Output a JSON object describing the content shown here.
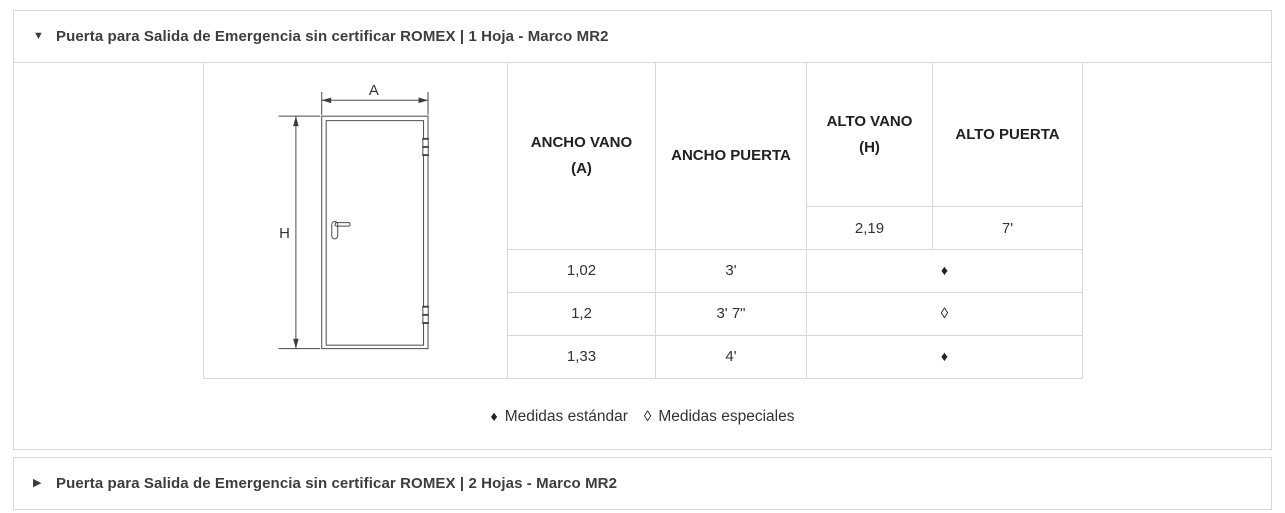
{
  "icons": {
    "expanded_glyph": "▼",
    "collapsed_glyph": "▶"
  },
  "sections": {
    "expanded": {
      "title": "Puerta para Salida de Emergencia sin certificar ROMEX | 1 Hoja - Marco MR2"
    },
    "collapsed": {
      "title": "Puerta para Salida de Emergencia sin certificar ROMEX | 2 Hojas - Marco MR2"
    }
  },
  "diagram": {
    "width_label": "A",
    "height_label": "H"
  },
  "spec_table": {
    "headers": {
      "ancho_vano_line1": "ANCHO VANO",
      "ancho_vano_line2": "(A)",
      "ancho_puerta": "ANCHO PUERTA",
      "alto_vano_line1": "ALTO VANO",
      "alto_vano_line2": "(H)",
      "alto_puerta": "ALTO PUERTA"
    },
    "alto_values": {
      "alto_vano": "2,19",
      "alto_puerta": "7'"
    },
    "rows": [
      {
        "ancho_vano": "1,02",
        "ancho_puerta": "3'",
        "marker": "♦"
      },
      {
        "ancho_vano": "1,2",
        "ancho_puerta": "3' 7\"",
        "marker": "◊"
      },
      {
        "ancho_vano": "1,33",
        "ancho_puerta": "4'",
        "marker": "♦"
      }
    ]
  },
  "legend": {
    "standard_symbol": "♦",
    "standard_label": "Medidas estándar",
    "special_symbol": "◊",
    "special_label": "Medidas especiales"
  },
  "colors": {
    "border": "#d8d8d8",
    "title_text": "#3d3d3d",
    "table_header_text": "#212121",
    "table_body_text": "#333333"
  }
}
